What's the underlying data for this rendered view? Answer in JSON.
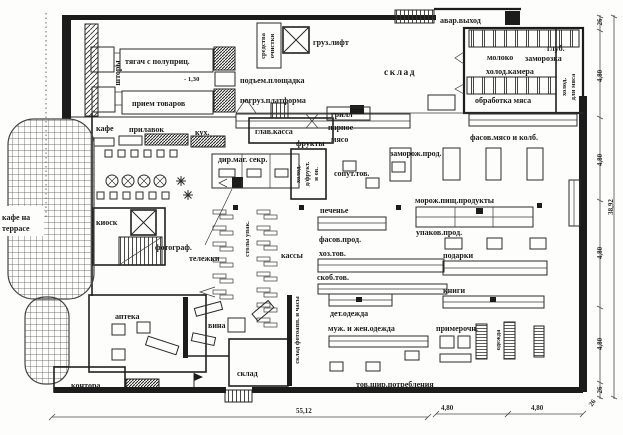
{
  "colors": {
    "ink": "#1c1c1c",
    "paper": "#fdfdfc"
  },
  "dock": {
    "curtains": "шторы",
    "truck_semitrailer": "тягач с полуприц.",
    "level_mark": "- 1,30",
    "goods_reception": "прием товаров",
    "lift_platform": "подъем.площадка",
    "loading_platform": "погруз.платформа",
    "cleaning_line1": "средства",
    "cleaning_line2": "очистки",
    "cargo_lift": "груз.лифт"
  },
  "storage": {
    "warehouse": "склад",
    "emergency_exit": "авар.выход",
    "milk": "молоко",
    "deep_freeze_line1": "глуб.",
    "deep_freeze_line2": "заморозка",
    "cold_chamber": "холод.камера",
    "meat_processing": "обработка мяса",
    "meat_cold_line1": "холод.",
    "meat_cold_line2": "для мяса"
  },
  "counters": {
    "grill": "грилл",
    "fresh_line1": "парное",
    "fresh_line2": "мясо",
    "packed_meat": "фасов.мясо и колб.",
    "frozen": "заморож.прод."
  },
  "cafe": {
    "cafe": "кафе",
    "counter": "прилавок",
    "kitchen": "кух.",
    "terrace_line1": "кафе на",
    "terrace_line2": "террасе",
    "kiosk": "киоск"
  },
  "service": {
    "main_cash": "глав.касса",
    "director": "дир.маг. секр.",
    "fruits": "фрукты",
    "fruit_cold_line1": "холод.",
    "fruit_cold_line2": "д/фрукт.",
    "fruit_cold_line3": "и ов.",
    "photographer": "фотограф.",
    "carts": "тележки",
    "packing_tables": "столы упак.",
    "checkouts": "кассы",
    "camera_watch_storage": "склад фотоапп. и часы",
    "pharmacy": "аптека",
    "office": "контора",
    "wine": "вина",
    "warehouse": "склад"
  },
  "sales": {
    "related_goods": "сопут.тов.",
    "cookies": "печенье",
    "packaged_food": "фасов.прод.",
    "household": "хоз.тов.",
    "hardware": "скоб.тов.",
    "frozen_food": "морож.пищ.продукты",
    "packaged_goods": "упаков.прод.",
    "gifts": "подарки",
    "books": "книги",
    "kids_clothes": "дет.одежда",
    "adult_clothes": "муж. и жен.одежда",
    "fitting_rooms": "примерочн.",
    "clothes_rack": "одежда",
    "consumer_goods": "тов.шир.потребления"
  },
  "dimensions": {
    "bottom_total": "55,12",
    "bottom_seg1": "4,80",
    "bottom_seg2": "4,80",
    "bottom_corner": "26",
    "right_total": "38,92",
    "right_chain": [
      "26",
      "4,80",
      "4,80",
      "4,80",
      "4,80",
      "26"
    ]
  }
}
